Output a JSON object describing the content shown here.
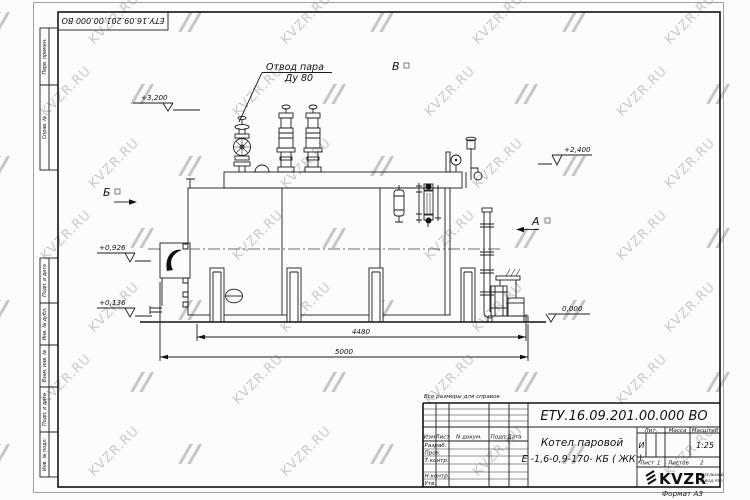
{
  "watermark": {
    "text": "KVZR.RU",
    "color": "#c9c9c9"
  },
  "stamp": {
    "doc_number_inverted": "ЕТУ.16.09.201.00.000  ВО"
  },
  "margin": {
    "top": [
      {
        "label": "Перв. примен."
      },
      {
        "label": "Справ. №"
      }
    ],
    "bottom": [
      {
        "label": "Подп. и дата"
      },
      {
        "label": "Инв. № дубл."
      },
      {
        "label": "Взам. инв. №"
      },
      {
        "label": "Подп. и дата"
      },
      {
        "label": "Инв. № подл."
      }
    ]
  },
  "drawing": {
    "callout": {
      "line1": "Отвод пара",
      "line2": "Ду 80"
    },
    "view_b": "Б",
    "view_v": "В",
    "view_a": "А",
    "elev_3200": "+3,200",
    "elev_2400": "+2,400",
    "elev_0926": "+0,926",
    "elev_0136": "+0,136",
    "elev_0000": "0,000",
    "dim_4480": "4480",
    "dim_5000": "5000"
  },
  "note": "Все размеры для справок",
  "title_block": {
    "doc_number": "ЕТУ.16.09.201.00.000  ВО",
    "product_name_1": "Котел паровой",
    "product_name_2": "Е -1,6-0,9-170- КБ ( ЖК )",
    "col_izm": "Изм",
    "col_list": "Лист",
    "col_ndoc": "N докум.",
    "col_podp": "Подп.",
    "col_data": "Дата",
    "row_razrab": "Разраб.",
    "row_prov": "Пров.",
    "row_tkontr": "Т.контр.",
    "row_nkontr": "Н.контр.",
    "row_utv": "Утв.",
    "lit_label": "Лит.",
    "mass_label": "Масса",
    "scale_label": "Масштаб",
    "lit_value": "И",
    "scale_value": "1:25",
    "list_label": "Лист",
    "list_value": "1",
    "listov_label": "Листов",
    "listov_value": "2",
    "logo": "KVZR",
    "logo_sub1": "КОТЕЛЬНЫЙ",
    "logo_sub2": "ЗАВОД РЭП",
    "format": "Формат А3"
  }
}
